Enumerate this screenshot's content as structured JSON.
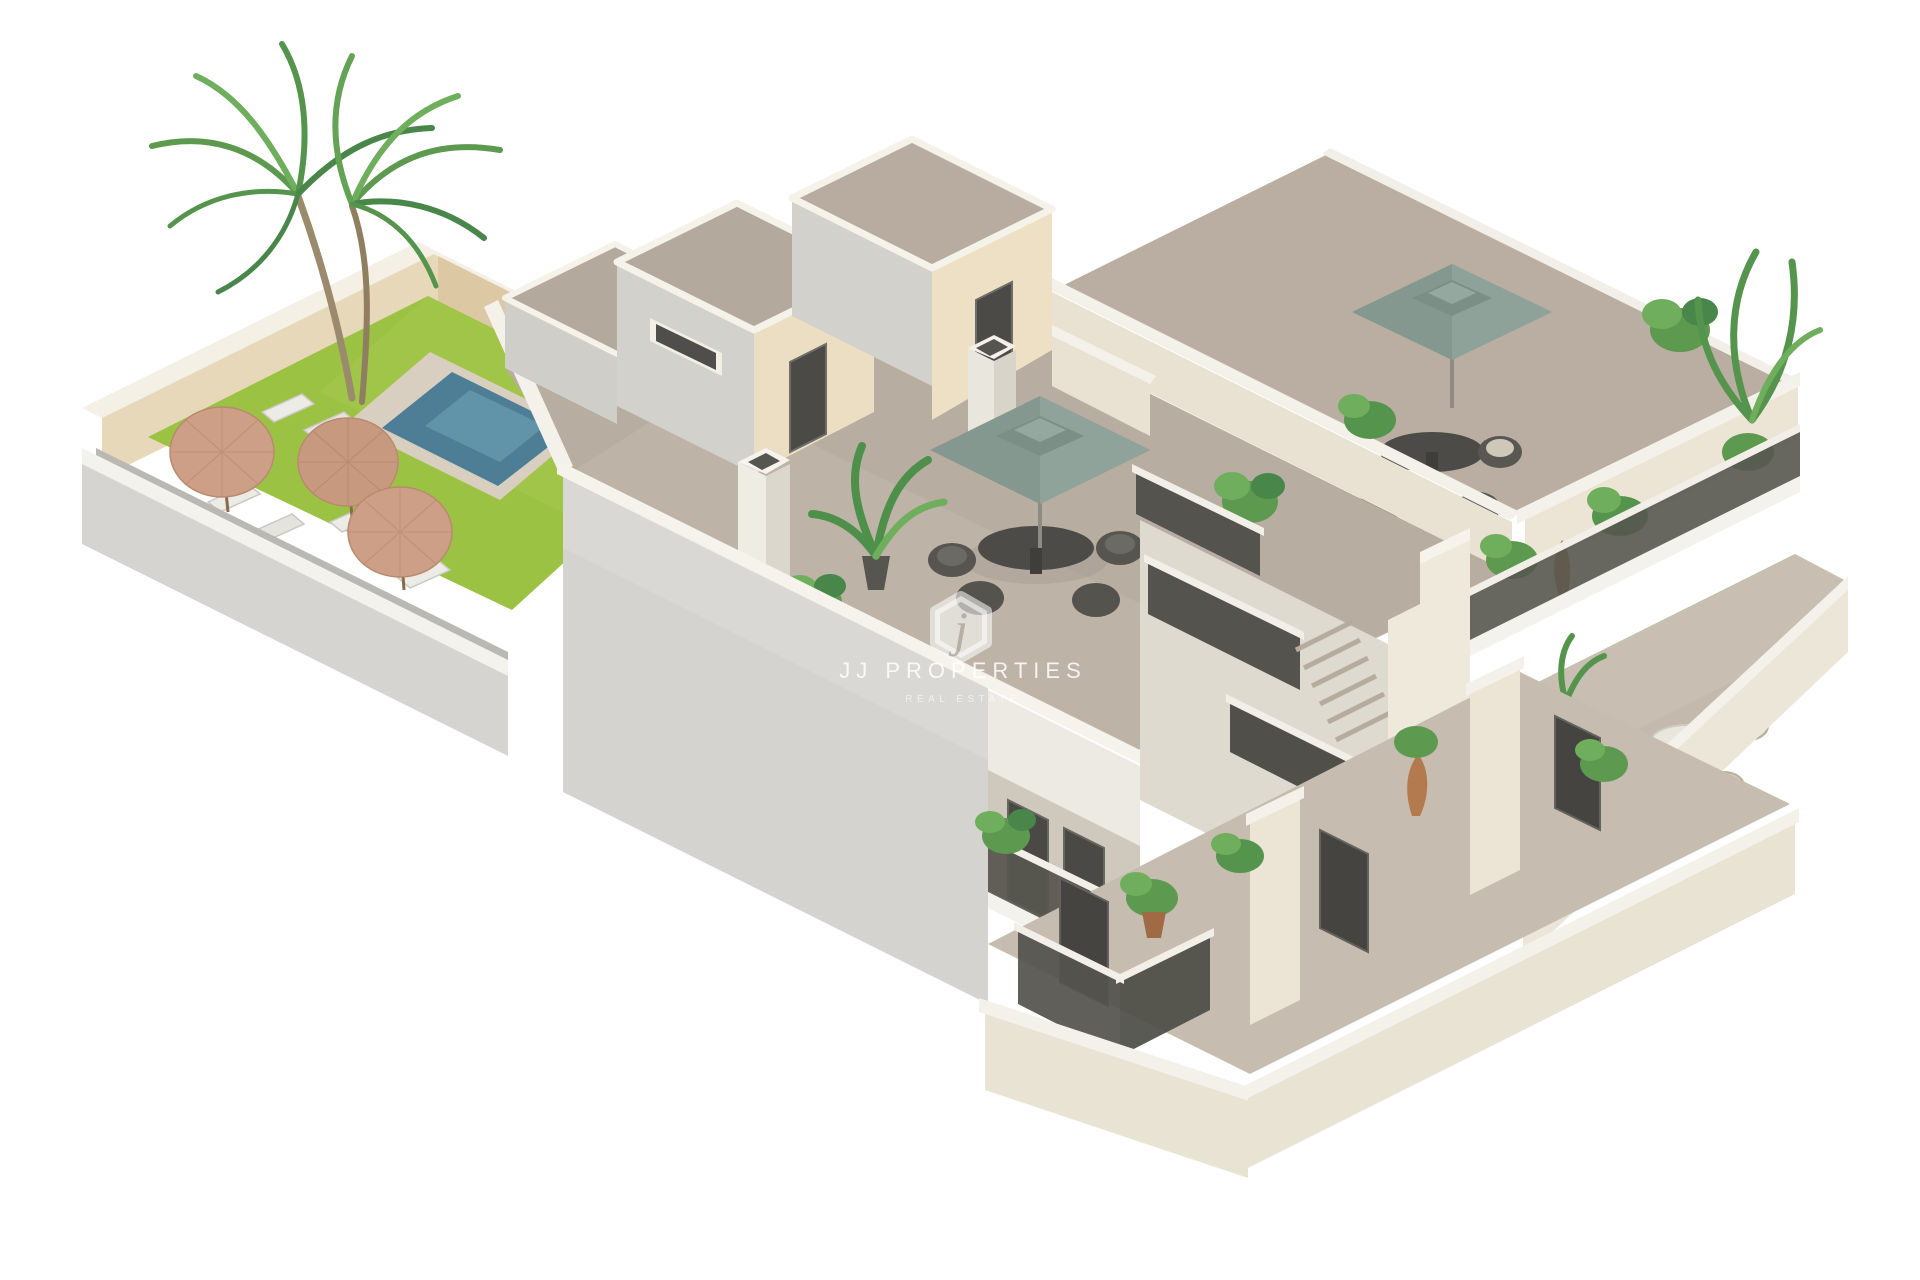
{
  "meta": {
    "alt": "Isometric 3D cutaway rendering of a two-storey apartment building with rooftop terraces, teal parasols, a central staircase with dark mesh railings, balconies with plants, and a walled garden with lawn, swimming pool, straw umbrellas, sun loungers and a palm tree, on a white background."
  },
  "watermark": {
    "monogram": "j",
    "brand": "JJ PROPERTIES",
    "tagline": "REAL ESTATE"
  },
  "palette": {
    "background": "#ffffff",
    "lawn_green": "#9cc244",
    "pool_water": "#4d7e95",
    "sand_wall": "#e7d8ba",
    "gray_wall": "#d4d3cf",
    "roof_floor_taupe": "#b7ada0",
    "white_trim": "#f5f2ea",
    "teal_umbrella": "#84988f",
    "straw_umbrella": "#cd9f86",
    "railing_dark": "#56554f",
    "door_dark": "#4a4945",
    "foliage_green": "#5d9a50",
    "terracotta_pot": "#a06b44"
  }
}
